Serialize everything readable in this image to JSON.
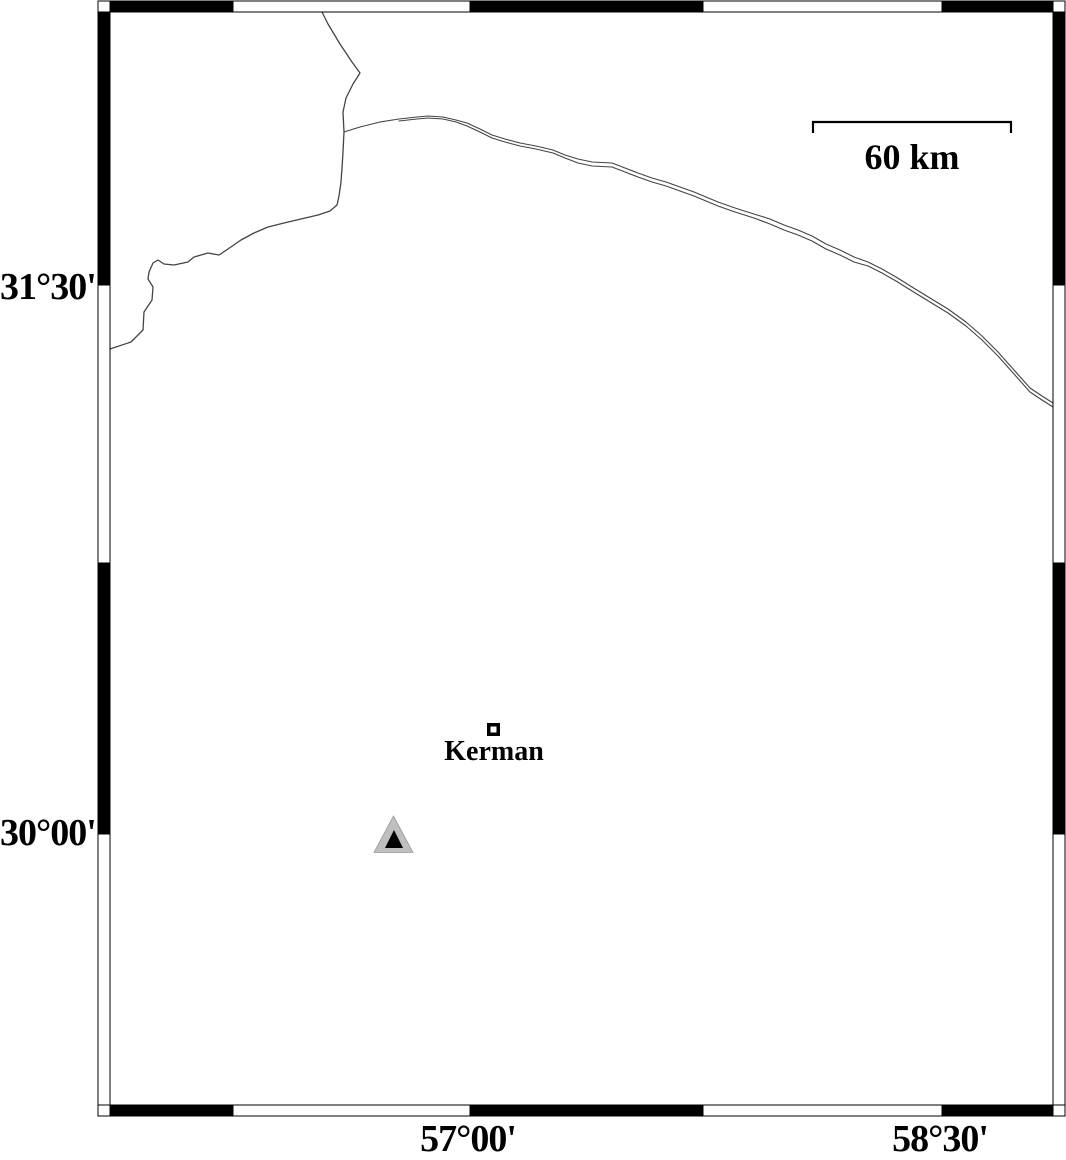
{
  "figure": {
    "width": 1066,
    "height": 1154,
    "background": "#ffffff",
    "ink": "#000000"
  },
  "frame": {
    "style": "alternating-black-white-fancy-border",
    "band_black": "#000000",
    "band_white": "#ffffff",
    "outer": {
      "x1": 98,
      "y1": 1,
      "x2": 1065,
      "y2": 1116
    },
    "inner": {
      "x1": 110,
      "y1": 12,
      "x2": 1053,
      "y2": 1105
    },
    "x_ticks": [
      110,
      233,
      470,
      703,
      942,
      1053
    ],
    "y_ticks": [
      12,
      285,
      563,
      834,
      1105
    ],
    "labels_left": [
      {
        "text": "31°30'",
        "y": 288
      },
      {
        "text": "30°00'",
        "y": 834
      }
    ],
    "labels_bottom": [
      {
        "text": "57°00'",
        "x": 468,
        "y": 1120
      },
      {
        "text": "58°30'",
        "x": 940,
        "y": 1120
      }
    ]
  },
  "scale_bar": {
    "label": "60 km",
    "x1": 813,
    "x2": 1011,
    "y": 122,
    "tick_len": 11,
    "stroke_width": 2.2,
    "label_x": 912,
    "label_y": 139
  },
  "markers": {
    "city": {
      "label": "Kerman",
      "square_cx": 493.5,
      "square_cy": 729.5,
      "square_size": 13,
      "square_border": 3.5,
      "fill": "#ffffff",
      "stroke": "#000000",
      "label_x": 494,
      "label_y": 738
    },
    "station": {
      "outer_triangle": {
        "points": [
          [
            393.5,
            816
          ],
          [
            374,
            852.5
          ],
          [
            413,
            852.5
          ]
        ],
        "fill": "#bfbfbf",
        "stroke": "#9a9a9a"
      },
      "inner_triangle": {
        "points": [
          [
            394,
            830
          ],
          [
            385,
            848
          ],
          [
            403,
            848
          ]
        ],
        "fill": "#000000"
      }
    }
  },
  "roads": {
    "stroke": "#444444",
    "lines": [
      {
        "name": "north-road",
        "width": 1.3,
        "points": [
          [
            322,
            12
          ],
          [
            328,
            24
          ],
          [
            340,
            44
          ],
          [
            352,
            62
          ],
          [
            360,
            73
          ],
          [
            353,
            84
          ],
          [
            346,
            98
          ],
          [
            343,
            112
          ],
          [
            344,
            132
          ],
          [
            343,
            152
          ],
          [
            342,
            168
          ],
          [
            341,
            182
          ],
          [
            339,
            196
          ],
          [
            337,
            205
          ],
          [
            330,
            211
          ],
          [
            318,
            215
          ],
          [
            301,
            219
          ],
          [
            284,
            223
          ],
          [
            268,
            227
          ],
          [
            254,
            233
          ],
          [
            241,
            240
          ],
          [
            228,
            249
          ],
          [
            219,
            255
          ],
          [
            208,
            253
          ],
          [
            194,
            257
          ],
          [
            188,
            262
          ],
          [
            174,
            265
          ],
          [
            164,
            264
          ],
          [
            158,
            260
          ],
          [
            153,
            263
          ],
          [
            149,
            272
          ],
          [
            148,
            279
          ],
          [
            153,
            287
          ],
          [
            152,
            300
          ],
          [
            144,
            312
          ],
          [
            143,
            330
          ],
          [
            131,
            342
          ],
          [
            110,
            349
          ]
        ]
      },
      {
        "name": "east-road-upper",
        "width": 1.1,
        "points": [
          [
            344,
            132
          ],
          [
            360,
            127
          ],
          [
            380,
            122
          ],
          [
            399,
            119
          ],
          [
            417,
            117
          ],
          [
            428,
            116
          ],
          [
            443,
            117
          ],
          [
            456,
            120
          ],
          [
            467,
            123
          ],
          [
            480,
            129
          ],
          [
            492,
            135
          ],
          [
            505,
            139
          ],
          [
            520,
            143
          ],
          [
            536,
            146
          ],
          [
            553,
            150
          ],
          [
            565,
            155
          ],
          [
            578,
            159
          ],
          [
            592,
            162
          ],
          [
            612,
            163
          ],
          [
            625,
            168
          ],
          [
            638,
            173
          ],
          [
            652,
            178
          ],
          [
            666,
            182
          ],
          [
            680,
            187
          ],
          [
            694,
            192
          ],
          [
            706,
            197
          ],
          [
            718,
            202
          ],
          [
            735,
            208
          ],
          [
            754,
            214
          ],
          [
            770,
            219
          ],
          [
            784,
            225
          ],
          [
            798,
            230
          ],
          [
            812,
            236
          ],
          [
            826,
            244
          ],
          [
            840,
            250
          ],
          [
            854,
            257
          ],
          [
            868,
            262
          ],
          [
            882,
            269
          ],
          [
            896,
            277
          ],
          [
            912,
            287
          ],
          [
            930,
            298
          ],
          [
            948,
            309
          ],
          [
            966,
            322
          ],
          [
            982,
            336
          ],
          [
            998,
            352
          ],
          [
            1014,
            370
          ],
          [
            1030,
            388
          ],
          [
            1042,
            396
          ],
          [
            1053,
            403
          ]
        ]
      },
      {
        "name": "east-road-lower",
        "width": 1.1,
        "points": [
          [
            399,
            121
          ],
          [
            417,
            119
          ],
          [
            428,
            118
          ],
          [
            443,
            119
          ],
          [
            456,
            122
          ],
          [
            467,
            126
          ],
          [
            480,
            132
          ],
          [
            492,
            138
          ],
          [
            505,
            142
          ],
          [
            520,
            146
          ],
          [
            536,
            149
          ],
          [
            553,
            153
          ],
          [
            565,
            158
          ],
          [
            578,
            163
          ],
          [
            592,
            166
          ],
          [
            612,
            167
          ],
          [
            625,
            172
          ],
          [
            638,
            177
          ],
          [
            652,
            182
          ],
          [
            666,
            186
          ],
          [
            680,
            191
          ],
          [
            694,
            196
          ],
          [
            706,
            201
          ],
          [
            718,
            206
          ],
          [
            735,
            212
          ],
          [
            754,
            218
          ],
          [
            770,
            224
          ],
          [
            784,
            230
          ],
          [
            798,
            235
          ],
          [
            812,
            241
          ],
          [
            826,
            249
          ],
          [
            840,
            255
          ],
          [
            854,
            262
          ],
          [
            868,
            266
          ],
          [
            882,
            273
          ],
          [
            896,
            281
          ],
          [
            912,
            291
          ],
          [
            930,
            302
          ],
          [
            948,
            313
          ],
          [
            966,
            326
          ],
          [
            982,
            340
          ],
          [
            998,
            356
          ],
          [
            1014,
            374
          ],
          [
            1030,
            392
          ],
          [
            1042,
            400
          ],
          [
            1053,
            407
          ]
        ]
      }
    ]
  }
}
